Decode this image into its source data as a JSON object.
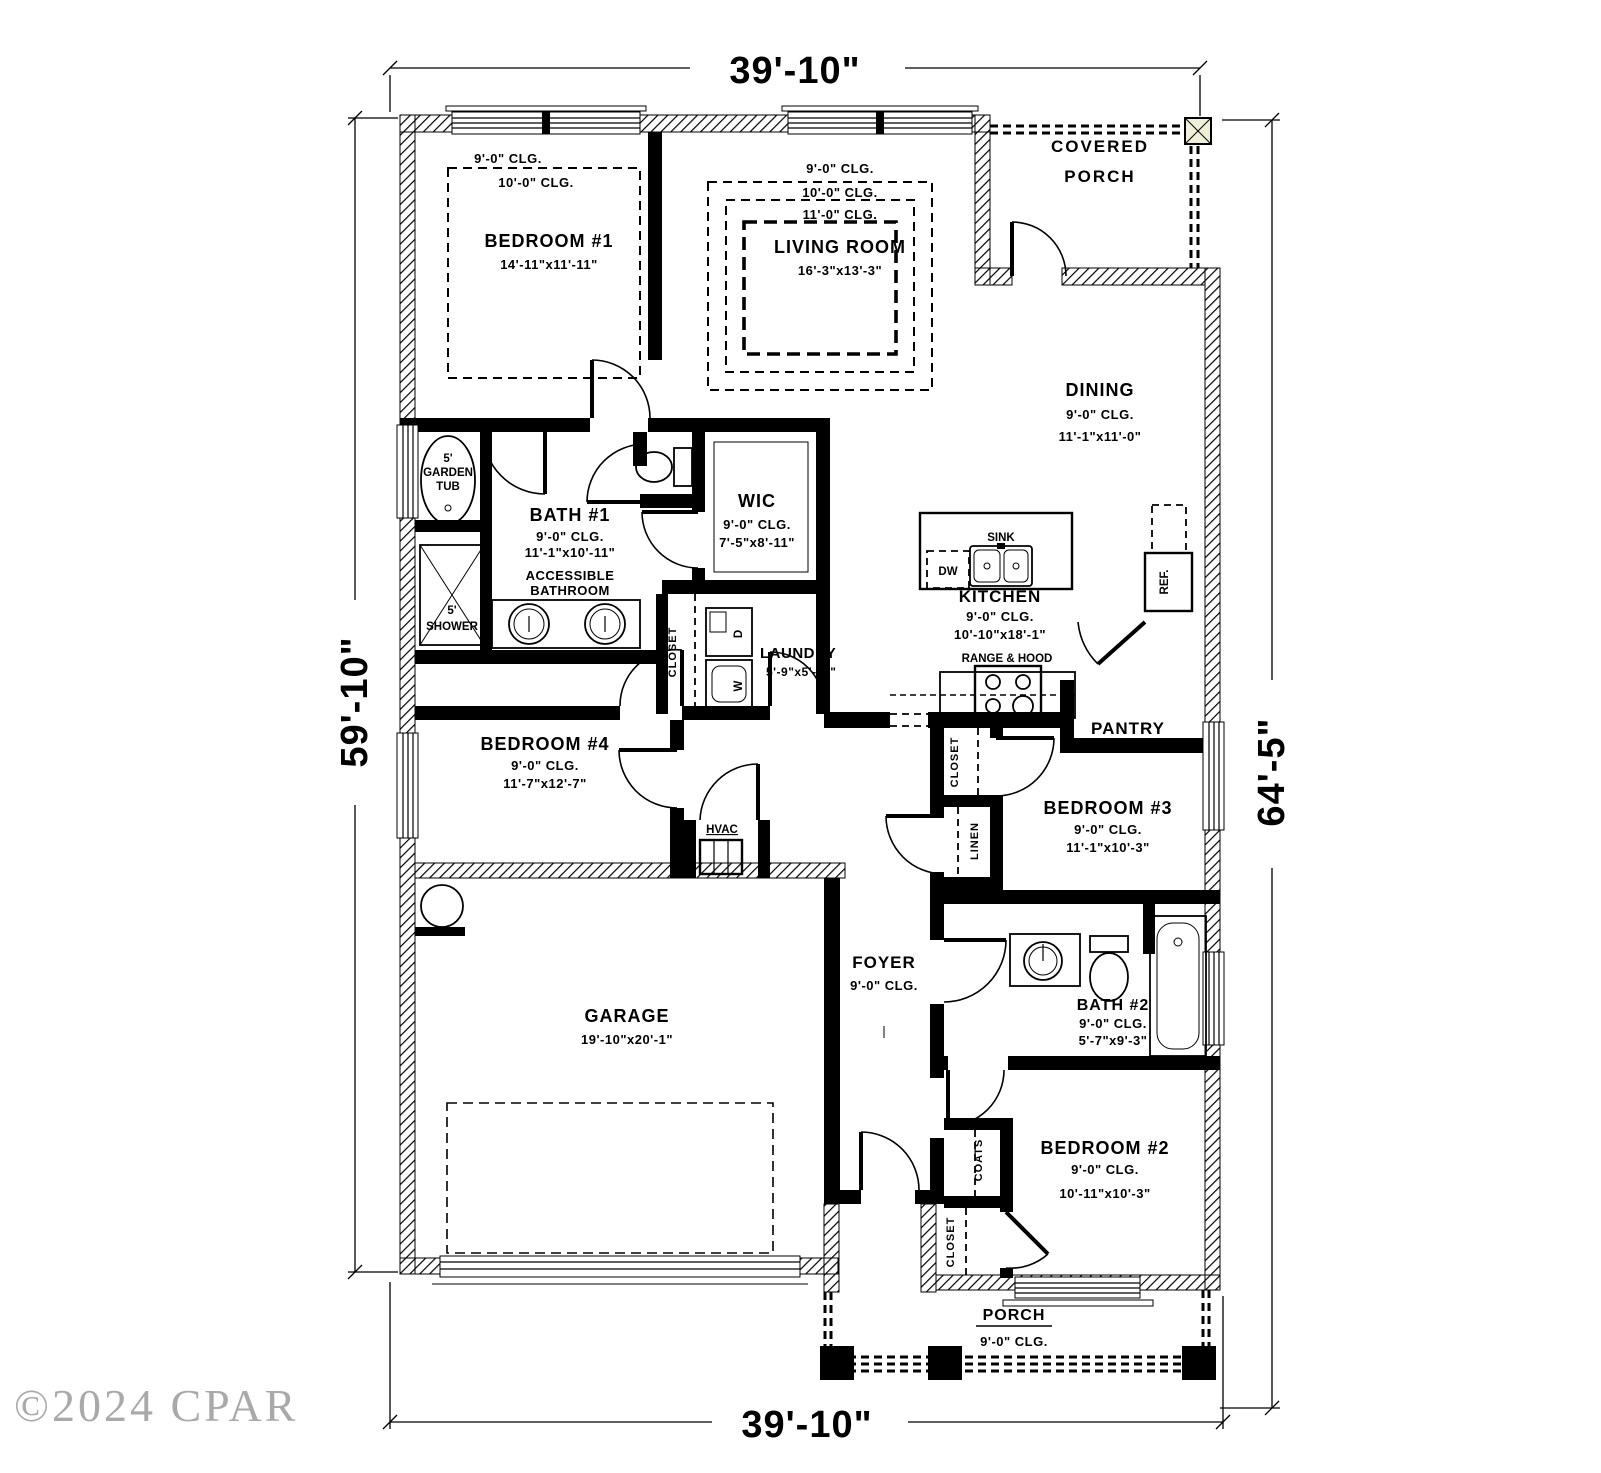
{
  "colors": {
    "paper": "#ffffff",
    "ink": "#000000",
    "post_fill": "#f0f0d8",
    "watermark": "#a9a9a9"
  },
  "dims": {
    "top": "39'-10\"",
    "bottom": "39'-10\"",
    "left": "59'-10\"",
    "right": "64'-5\""
  },
  "rooms": {
    "covered_porch": {
      "line1": "COVERED",
      "line2": "PORCH"
    },
    "bedroom1": {
      "name": "BEDROOM #1",
      "clg1": "9'-0\" CLG.",
      "clg2": "10'-0\" CLG.",
      "size": "14'-11\"x11'-11\""
    },
    "living": {
      "name": "LIVING ROOM",
      "clg1": "9'-0\" CLG.",
      "clg2": "10'-0\" CLG.",
      "clg3": "11'-0\" CLG.",
      "size": "16'-3\"x13'-3\""
    },
    "dining": {
      "name": "DINING",
      "clg": "9'-0\" CLG.",
      "size": "11'-1\"x11'-0\""
    },
    "bath1": {
      "name": "BATH #1",
      "clg": "9'-0\" CLG.",
      "size": "11'-1\"x10'-11\"",
      "note1": "ACCESSIBLE",
      "note2": "BATHROOM"
    },
    "wic": {
      "name": "WIC",
      "clg": "9'-0\" CLG.",
      "size": "7'-5\"x8'-11\""
    },
    "laundry": {
      "name": "LAUNDRY",
      "size": "5'-9\"x5'-11\""
    },
    "kitchen": {
      "name": "KITCHEN",
      "clg": "9'-0\" CLG.",
      "size": "10'-10\"x18'-1\""
    },
    "pantry": {
      "name": "PANTRY"
    },
    "bedroom4": {
      "name": "BEDROOM #4",
      "clg": "9'-0\" CLG.",
      "size": "11'-7\"x12'-7\""
    },
    "bedroom3": {
      "name": "BEDROOM #3",
      "clg": "9'-0\" CLG.",
      "size": "11'-1\"x10'-3\""
    },
    "foyer": {
      "name": "FOYER",
      "clg": "9'-0\" CLG."
    },
    "bath2": {
      "name": "BATH #2",
      "clg": "9'-0\" CLG.",
      "size": "5'-7\"x9'-3\""
    },
    "garage": {
      "name": "GARAGE",
      "size": "19'-10\"x20'-1\""
    },
    "bedroom2": {
      "name": "BEDROOM #2",
      "clg": "9'-0\" CLG.",
      "size": "10'-11\"x10'-3\""
    },
    "porch": {
      "name": "PORCH",
      "clg": "9'-0\" CLG."
    }
  },
  "fixtures": {
    "sink": "SINK",
    "dw": "DW",
    "ref": "REF.",
    "range": "RANGE & HOOD",
    "hvac": "HVAC",
    "washer": "W",
    "dryer": "D",
    "garden_tub": [
      "5'",
      "GARDEN",
      "TUB"
    ],
    "shower": [
      "5'",
      "SHOWER"
    ]
  },
  "closets": {
    "laundry_closet": "CLOSET",
    "bed3_closet": "CLOSET",
    "linen": "LINEN",
    "coats": "COATS",
    "bed2_closet": "CLOSET"
  },
  "watermark": "©2024 CPAR"
}
